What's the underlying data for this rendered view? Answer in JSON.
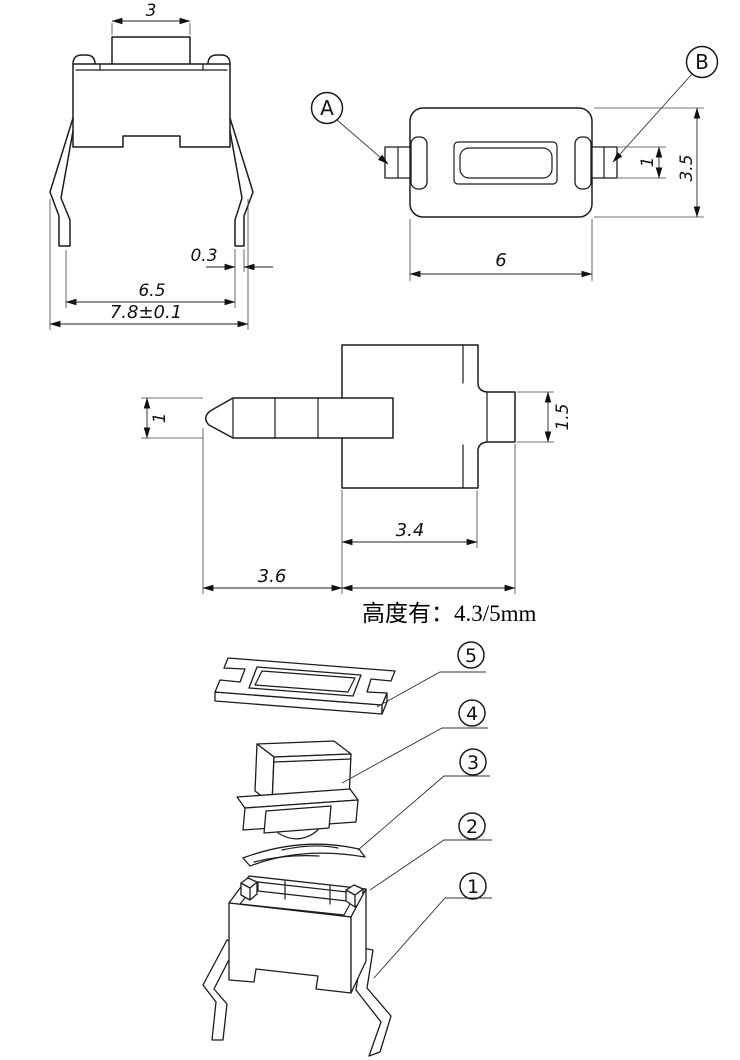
{
  "page": {
    "background": "#ffffff",
    "line_color": "#1c1c1c"
  },
  "drawing": {
    "front_view": {
      "dim_button_width": "3",
      "dim_lead_thickness": "0.3",
      "dim_lead_span": "6.5",
      "dim_overall_width": "7.8±0.1"
    },
    "top_view": {
      "detail_label_a": "A",
      "detail_label_b": "B",
      "dim_lead_length": "1",
      "dim_body_depth": "3.5",
      "dim_body_width": "6"
    },
    "side_view": {
      "dim_lead_width": "1",
      "dim_boss_height": "1.5",
      "dim_body_width": "3.4",
      "dim_lead_length": "3.6"
    },
    "height_note": "高度有：4.3/5mm",
    "exploded_view": {
      "callout_5": "5",
      "callout_4": "4",
      "callout_3": "3",
      "callout_2": "2",
      "callout_1": "1"
    }
  }
}
